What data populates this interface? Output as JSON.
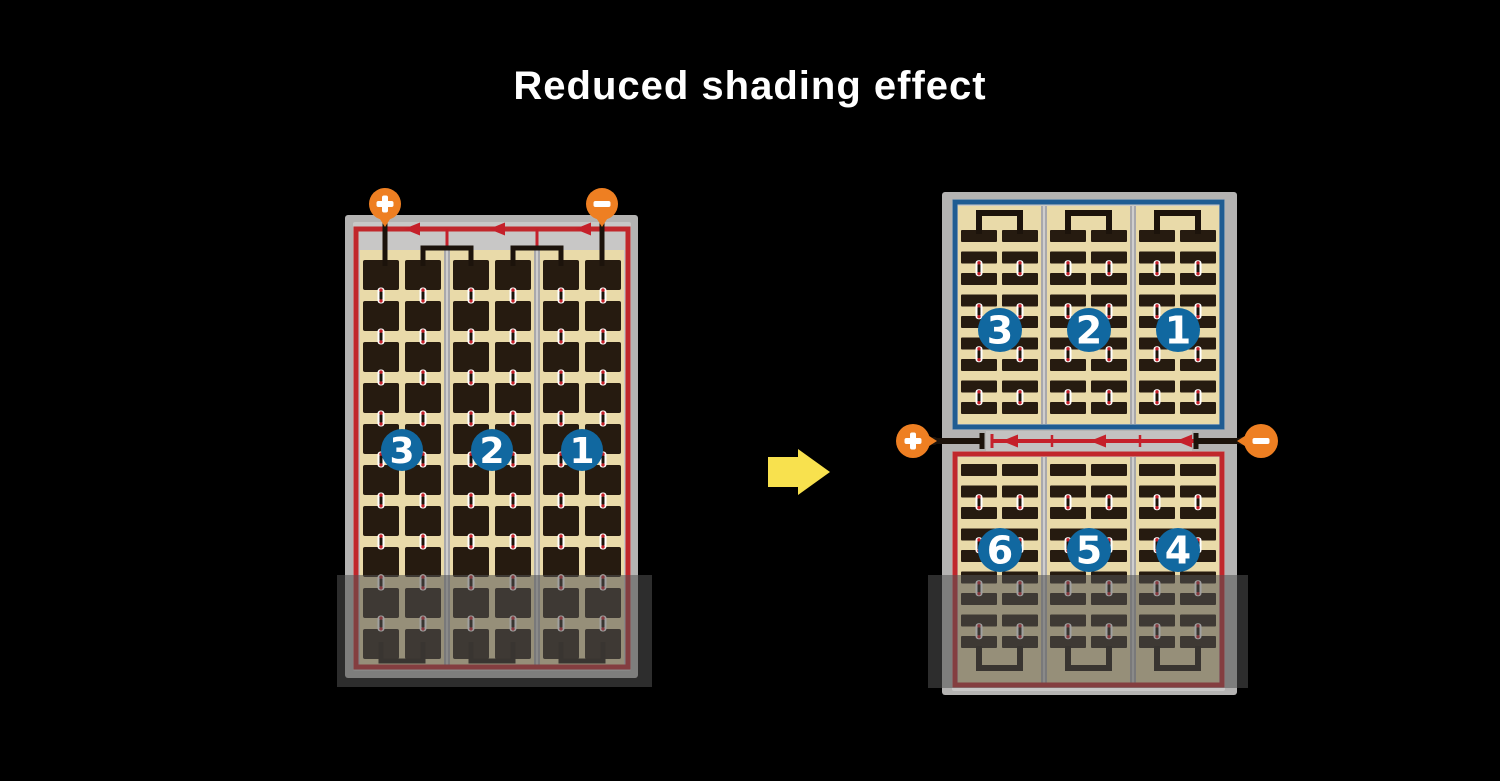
{
  "title": "Reduced shading effect",
  "colors": {
    "background": "#000000",
    "title_text": "#ffffff",
    "panel_frame": "#b4b3b2",
    "panel_inner": "#c8c7c6",
    "divider": "#a8a8ab",
    "divider_highlight": "#cfcecd",
    "cell_bed": "#e9daa9",
    "cell": "#261b10",
    "wire_black": "#1c130b",
    "wire_red": "#c5202a",
    "border_red": "#c1272b",
    "border_blue": "#1f5c92",
    "terminal_orange": "#ee7f22",
    "terminal_symbol": "#ffffff",
    "string_badge": "#1168a0",
    "badge_text": "#ffffff",
    "junction_strip": "#c3c2c1",
    "connector_body": "#ffffff",
    "arrow_yellow": "#f8e14e",
    "shade_overlay": "rgba(82,82,82,0.55)"
  },
  "before_module": {
    "terminals": [
      {
        "sign": "+"
      },
      {
        "sign": "−"
      }
    ],
    "string_labels": [
      "3",
      "2",
      "1"
    ],
    "bypass_diode_count": 3,
    "shaded": true
  },
  "after_modules": {
    "terminals": [
      {
        "sign": "+"
      },
      {
        "sign": "−"
      }
    ],
    "top_panel": {
      "string_labels": [
        "3",
        "2",
        "1"
      ]
    },
    "bottom_panel": {
      "string_labels": [
        "6",
        "5",
        "4"
      ],
      "shaded": true
    },
    "bypass_diode_count": 3
  }
}
